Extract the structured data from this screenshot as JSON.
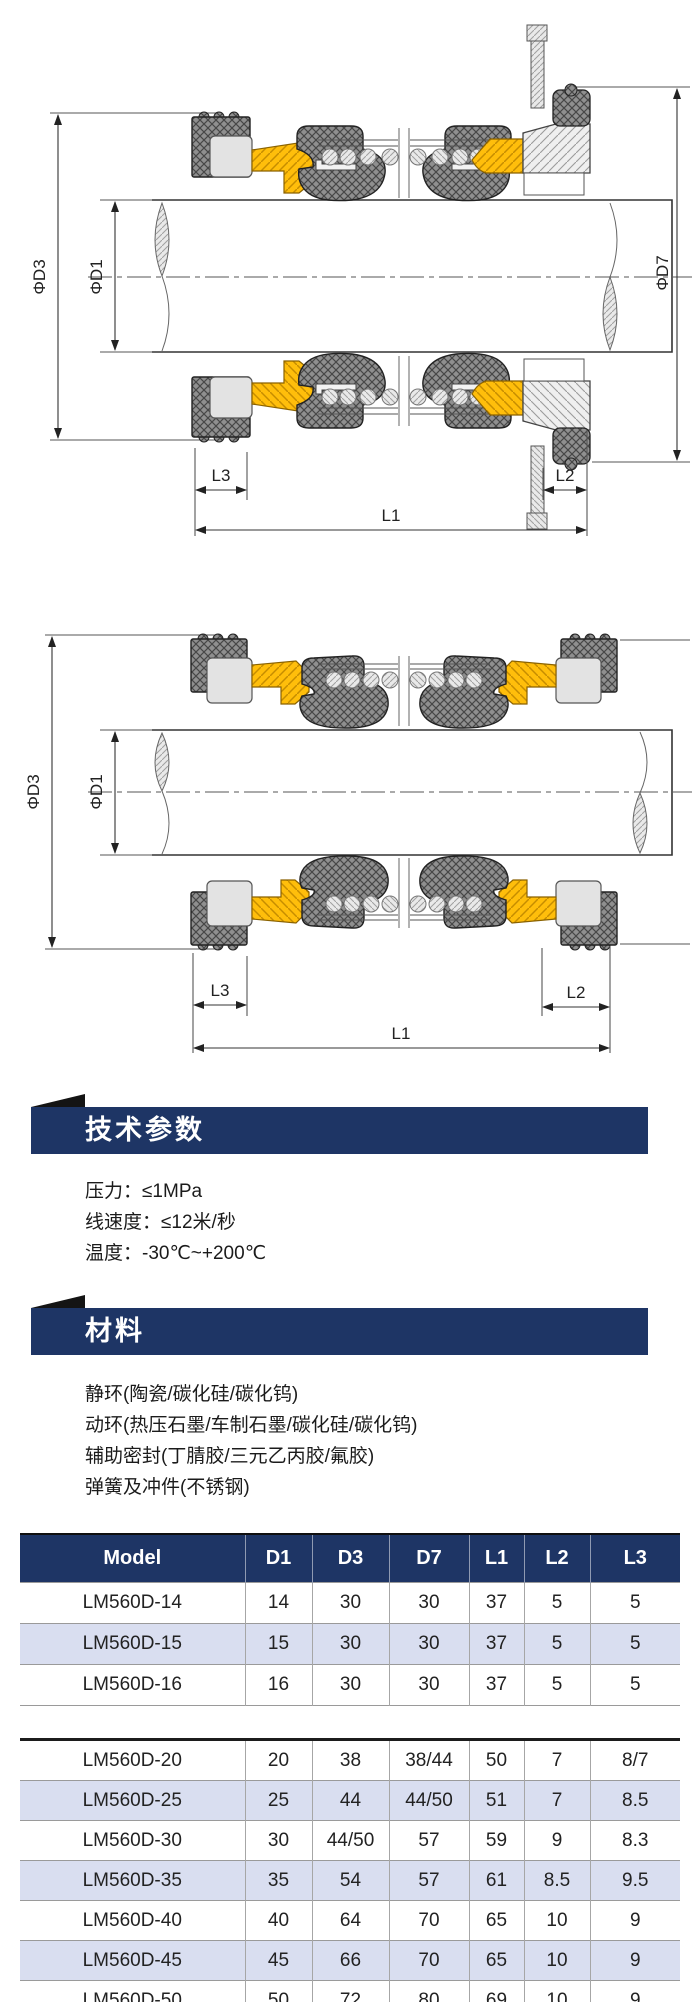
{
  "diagram1": {
    "labels": {
      "d3": "ΦD3",
      "d1": "ΦD1",
      "d7": "ΦD7",
      "l1": "L1",
      "l2": "L2",
      "l3": "L3"
    }
  },
  "diagram2": {
    "labels": {
      "d3": "ΦD3",
      "d1": "ΦD1",
      "l1": "L1",
      "l2": "L2",
      "l3": "L3"
    }
  },
  "tech_params": {
    "title": "技术参数",
    "lines": [
      "压力：≤1MPa",
      "线速度：≤12米/秒",
      "温度：-30℃~+200℃"
    ]
  },
  "materials": {
    "title": "材料",
    "lines": [
      "静环(陶瓷/碳化硅/碳化钨)",
      "动环(热压石墨/车制石墨/碳化硅/碳化钨)",
      "辅助密封(丁腈胶/三元乙丙胶/氟胶)",
      "弹簧及冲件(不锈钢)"
    ]
  },
  "table": {
    "columns": [
      "Model",
      "D1",
      "D3",
      "D7",
      "L1",
      "L2",
      "L3"
    ],
    "groups": [
      {
        "rows": [
          [
            "LM560D-14",
            "14",
            "30",
            "30",
            "37",
            "5",
            "5"
          ],
          [
            "LM560D-15",
            "15",
            "30",
            "30",
            "37",
            "5",
            "5"
          ],
          [
            "LM560D-16",
            "16",
            "30",
            "30",
            "37",
            "5",
            "5"
          ]
        ]
      },
      {
        "rows": [
          [
            "LM560D-20",
            "20",
            "38",
            "38/44",
            "50",
            "7",
            "8/7"
          ],
          [
            "LM560D-25",
            "25",
            "44",
            "44/50",
            "51",
            "7",
            "8.5"
          ],
          [
            "LM560D-30",
            "30",
            "44/50",
            "57",
            "59",
            "9",
            "8.3"
          ],
          [
            "LM560D-35",
            "35",
            "54",
            "57",
            "61",
            "8.5",
            "9.5"
          ],
          [
            "LM560D-40",
            "40",
            "64",
            "70",
            "65",
            "10",
            "9"
          ],
          [
            "LM560D-45",
            "45",
            "66",
            "70",
            "65",
            "10",
            "9"
          ],
          [
            "LM560D-50",
            "50",
            "72",
            "80",
            "69",
            "10",
            "9"
          ]
        ]
      }
    ]
  },
  "colors": {
    "navy": "#1e3565",
    "row_alt": "#d9def0",
    "accent_yellow": "#ffbe0b"
  }
}
